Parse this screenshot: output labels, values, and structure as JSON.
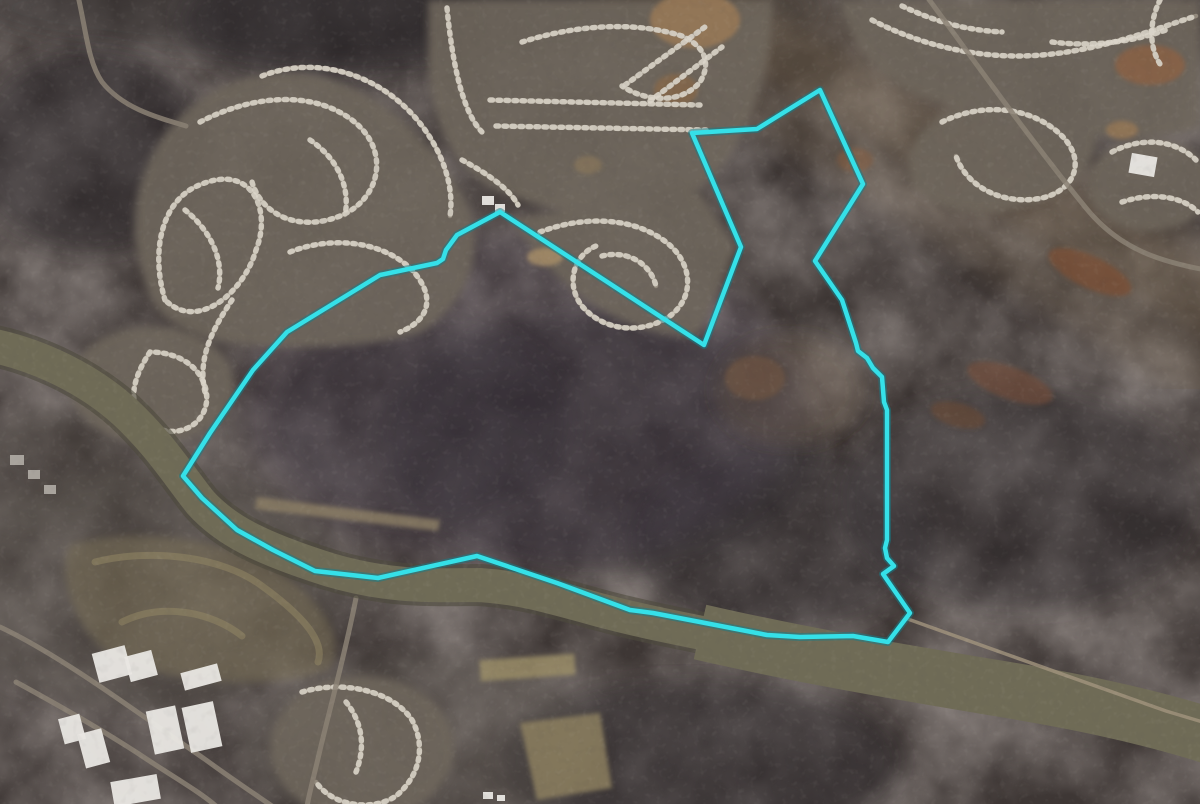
{
  "map": {
    "kind": "satellite-aerial-imagery",
    "canvas": {
      "width": 1200,
      "height": 804
    },
    "boundary_overlay": {
      "label": "parcel-boundary",
      "color": "#35e0e8",
      "glow_color": "#117e8a",
      "stroke_width": 4.5,
      "glow_width": 8,
      "closed": true,
      "points": [
        [
          500,
          212
        ],
        [
          704,
          345
        ],
        [
          741,
          247
        ],
        [
          692,
          133
        ],
        [
          757,
          129
        ],
        [
          820,
          90
        ],
        [
          863,
          184
        ],
        [
          815,
          261
        ],
        [
          842,
          300
        ],
        [
          856,
          343
        ],
        [
          858,
          351
        ],
        [
          867,
          358
        ],
        [
          873,
          368
        ],
        [
          882,
          377
        ],
        [
          884,
          402
        ],
        [
          887,
          410
        ],
        [
          887,
          540
        ],
        [
          885,
          548
        ],
        [
          887,
          558
        ],
        [
          894,
          566
        ],
        [
          883,
          574
        ],
        [
          910,
          613
        ],
        [
          888,
          642
        ],
        [
          853,
          636
        ],
        [
          800,
          637
        ],
        [
          767,
          635
        ],
        [
          700,
          622
        ],
        [
          653,
          613
        ],
        [
          630,
          610
        ],
        [
          557,
          583
        ],
        [
          477,
          556
        ],
        [
          378,
          578
        ],
        [
          315,
          571
        ],
        [
          273,
          550
        ],
        [
          237,
          530
        ],
        [
          202,
          498
        ],
        [
          183,
          476
        ],
        [
          210,
          433
        ],
        [
          253,
          370
        ],
        [
          287,
          332
        ],
        [
          380,
          275
        ],
        [
          437,
          263
        ],
        [
          443,
          259
        ],
        [
          446,
          250
        ],
        [
          457,
          235
        ]
      ]
    },
    "base_colors": {
      "forest": "#3d3634",
      "river": "#6f6b56",
      "river_bank": "#4d4a3c",
      "subdivision_ground": "#6e665c",
      "street": "#978e81",
      "rooftop": "#dcd6ca",
      "dirt_clearing": "#9c7b55",
      "rust_clearing": "#7d5038"
    },
    "features": [
      "river-crossing-southwest-to-southeast",
      "forested-parcel-inside-boundary",
      "residential-subdivisions-northwest",
      "residential-subdivisions-north-center",
      "residential-subdivisions-northeast",
      "utility-corridor-northeast",
      "warehouses-southwest",
      "golf-course-southwest"
    ]
  }
}
